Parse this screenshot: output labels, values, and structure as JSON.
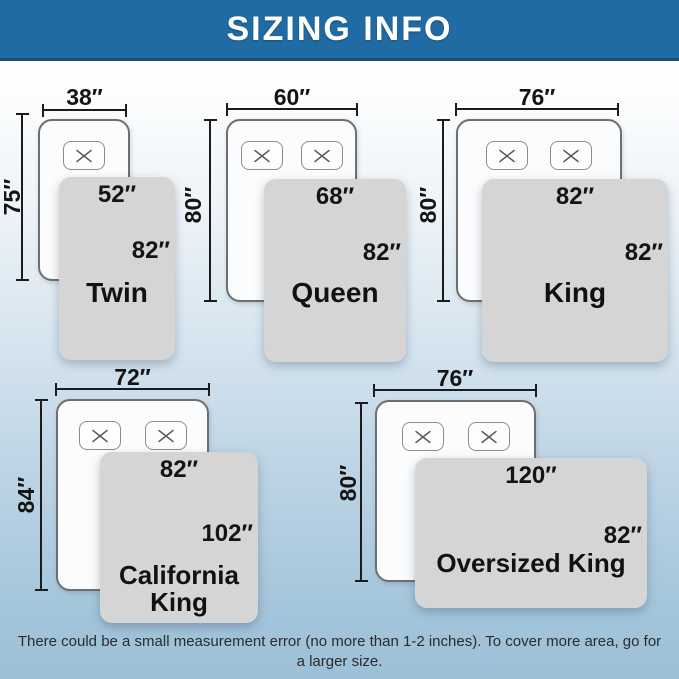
{
  "header": {
    "title": "SIZING INFO"
  },
  "sizes": [
    {
      "name": "Twin",
      "bed_width": "38″",
      "bed_length": "75″",
      "blanket_width": "52″",
      "blanket_length": "82″",
      "pillows": 1
    },
    {
      "name": "Queen",
      "bed_width": "60″",
      "bed_length": "80″",
      "blanket_width": "68″",
      "blanket_length": "82″",
      "pillows": 2
    },
    {
      "name": "King",
      "bed_width": "76″",
      "bed_length": "80″",
      "blanket_width": "82″",
      "blanket_length": "82″",
      "pillows": 2
    },
    {
      "name": "California King",
      "bed_width": "72″",
      "bed_length": "84″",
      "blanket_width": "82″",
      "blanket_length": "102″",
      "pillows": 2
    },
    {
      "name": "Oversized King",
      "bed_width": "76″",
      "bed_length": "80″",
      "blanket_width": "120″",
      "blanket_length": "82″",
      "pillows": 2
    }
  ],
  "footer": {
    "note": "There could be a small measurement error (no more than 1-2 inches). To cover more area, go for a larger size."
  },
  "colors": {
    "header_bg": "#216ba4",
    "header_border": "#1d4e72",
    "bg_top": "#ffffff",
    "bg_bottom": "#9cc0d8",
    "bed_fill": "#fbfcfd",
    "blanket_fill": "#d5d5d5",
    "line": "#1c1c1c",
    "text": "#141414"
  },
  "icons": {
    "pillow": "x-mark-icon"
  }
}
